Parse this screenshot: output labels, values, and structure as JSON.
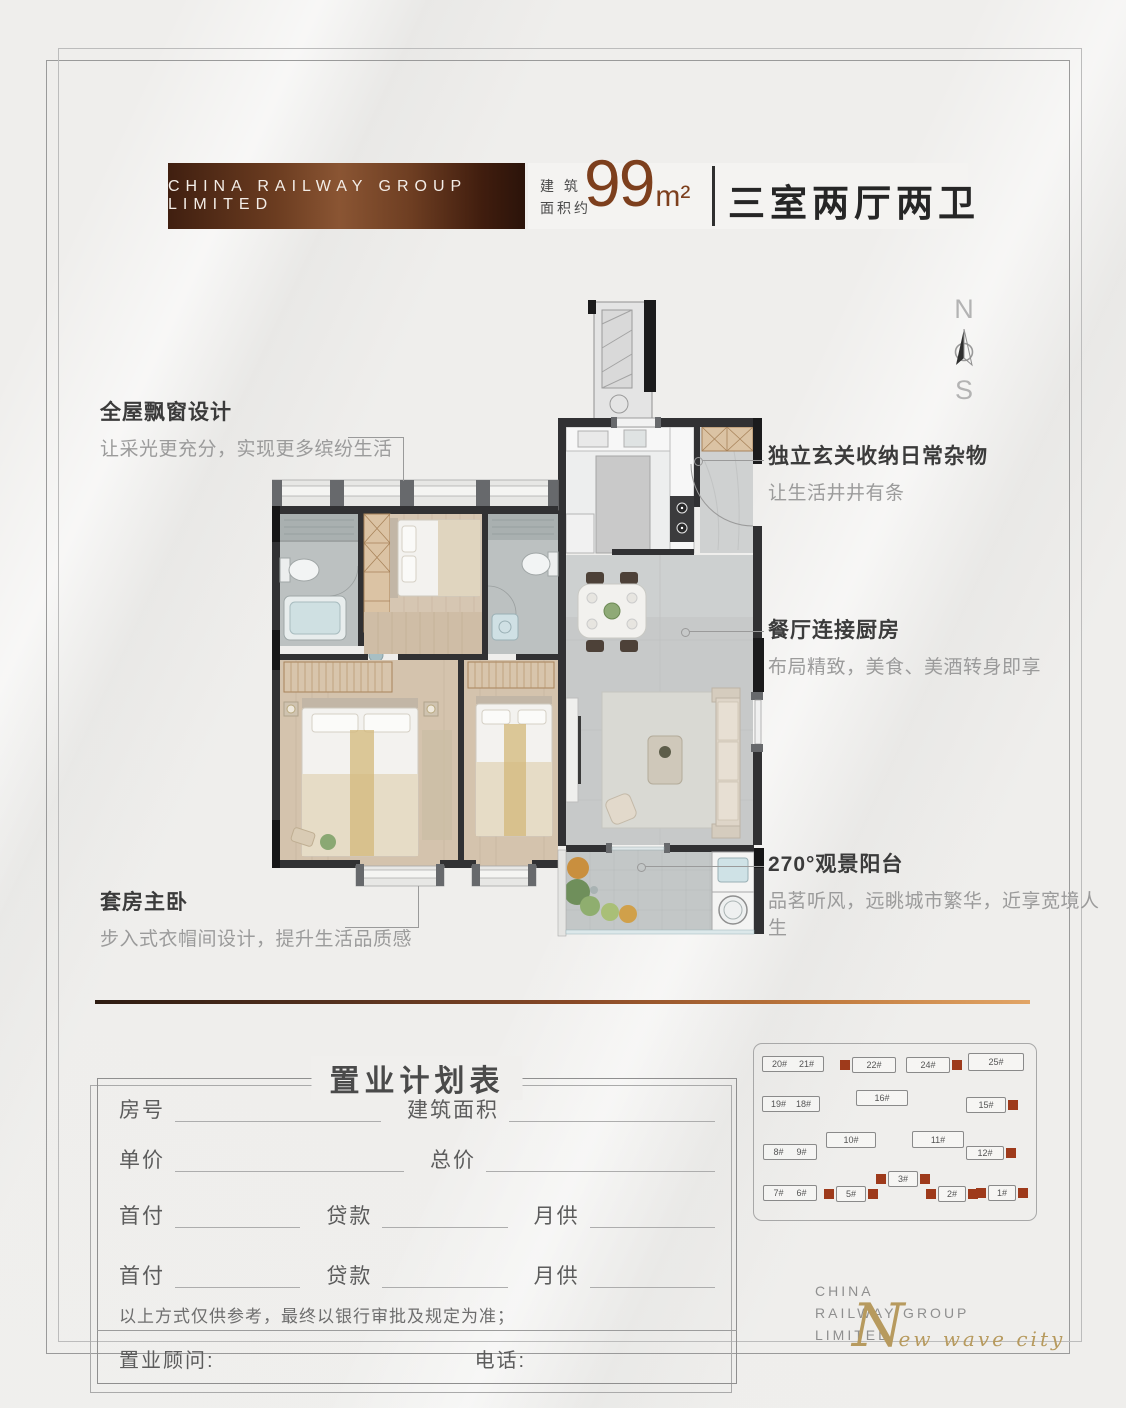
{
  "header": {
    "banner": "CHINA RAILWAY GROUP LIMITED",
    "area_label_line1": "建 筑",
    "area_label_line2": "面积约",
    "area_value": "99",
    "area_unit": "m²",
    "layout_name": "三室两厅两卫"
  },
  "compass": {
    "north": "N",
    "south": "S"
  },
  "annotations": {
    "left_top": {
      "title": "全屋飘窗设计",
      "desc": "让采光更充分，实现更多缤纷生活"
    },
    "left_bottom": {
      "title": "套房主卧",
      "desc": "步入式衣帽间设计，提升生活品质感"
    },
    "right_top": {
      "title": "独立玄关收纳日常杂物",
      "desc": "让生活井井有条"
    },
    "right_mid": {
      "title": "餐厅连接厨房",
      "desc": "布局精致，美食、美酒转身即享"
    },
    "right_bottom": {
      "title": "270°观景阳台",
      "desc": "品茗听风，远眺城市繁华，近享宽境人生"
    }
  },
  "form": {
    "title": "置业计划表",
    "rows": [
      [
        "房号",
        "建筑面积"
      ],
      [
        "单价",
        "总价"
      ],
      [
        "首付",
        "贷款",
        "月供"
      ],
      [
        "首付",
        "贷款",
        "月供"
      ]
    ],
    "disclaimer": "以上方式仅供参考，最终以银行审批及规定为准；",
    "consultant_label": "置业顾问:",
    "phone_label": "电话:"
  },
  "site_map": {
    "sold_color": "#9e3a1b",
    "buildings": [
      {
        "labels": [
          "20#",
          "21#"
        ],
        "x": 8,
        "y": 12,
        "w": 62,
        "h": 16
      },
      {
        "labels": [
          "22#"
        ],
        "x": 86,
        "y": 13,
        "w": 44,
        "h": 16,
        "sold": "left"
      },
      {
        "labels": [
          "24#"
        ],
        "x": 152,
        "y": 13,
        "w": 44,
        "h": 16,
        "sold": "right"
      },
      {
        "labels": [
          "25#"
        ],
        "x": 214,
        "y": 9,
        "w": 56,
        "h": 18
      },
      {
        "labels": [
          "19#",
          "18#"
        ],
        "x": 8,
        "y": 52,
        "w": 58,
        "h": 16
      },
      {
        "labels": [
          "16#"
        ],
        "x": 102,
        "y": 46,
        "w": 52,
        "h": 16
      },
      {
        "labels": [
          "15#"
        ],
        "x": 212,
        "y": 53,
        "w": 40,
        "h": 16,
        "sold": "right"
      },
      {
        "labels": [
          "8#",
          "9#"
        ],
        "x": 9,
        "y": 100,
        "w": 54,
        "h": 16
      },
      {
        "labels": [
          "10#"
        ],
        "x": 72,
        "y": 88,
        "w": 50,
        "h": 16
      },
      {
        "labels": [
          "11#"
        ],
        "x": 158,
        "y": 87,
        "w": 52,
        "h": 17
      },
      {
        "labels": [
          "12#"
        ],
        "x": 212,
        "y": 102,
        "w": 38,
        "h": 14,
        "sold": "right"
      },
      {
        "labels": [
          "7#",
          "6#"
        ],
        "x": 9,
        "y": 141,
        "w": 54,
        "h": 16
      },
      {
        "labels": [
          "5#"
        ],
        "x": 70,
        "y": 142,
        "w": 30,
        "h": 16,
        "sold": "both"
      },
      {
        "labels": [
          "3#"
        ],
        "x": 122,
        "y": 127,
        "w": 30,
        "h": 16,
        "sold": "both"
      },
      {
        "labels": [
          "2#"
        ],
        "x": 172,
        "y": 142,
        "w": 28,
        "h": 16,
        "sold": "both"
      },
      {
        "labels": [
          "1#"
        ],
        "x": 222,
        "y": 141,
        "w": 28,
        "h": 16,
        "sold": "both"
      }
    ]
  },
  "footer_logo": {
    "line1": "CHINA",
    "line2": "RAILWAY GROUP",
    "line3": "LIMITED",
    "script_initial": "N",
    "script_rest": "ew wave city"
  },
  "colors": {
    "accent_brown": "#7d3f1d",
    "banner_dark": "#401f10",
    "banner_light": "#8a5533",
    "sold_square": "#9e3a1b",
    "script_gold": "#b79a5e",
    "rule_gradient_start": "#2e1c12",
    "rule_gradient_end": "#e2a566"
  }
}
